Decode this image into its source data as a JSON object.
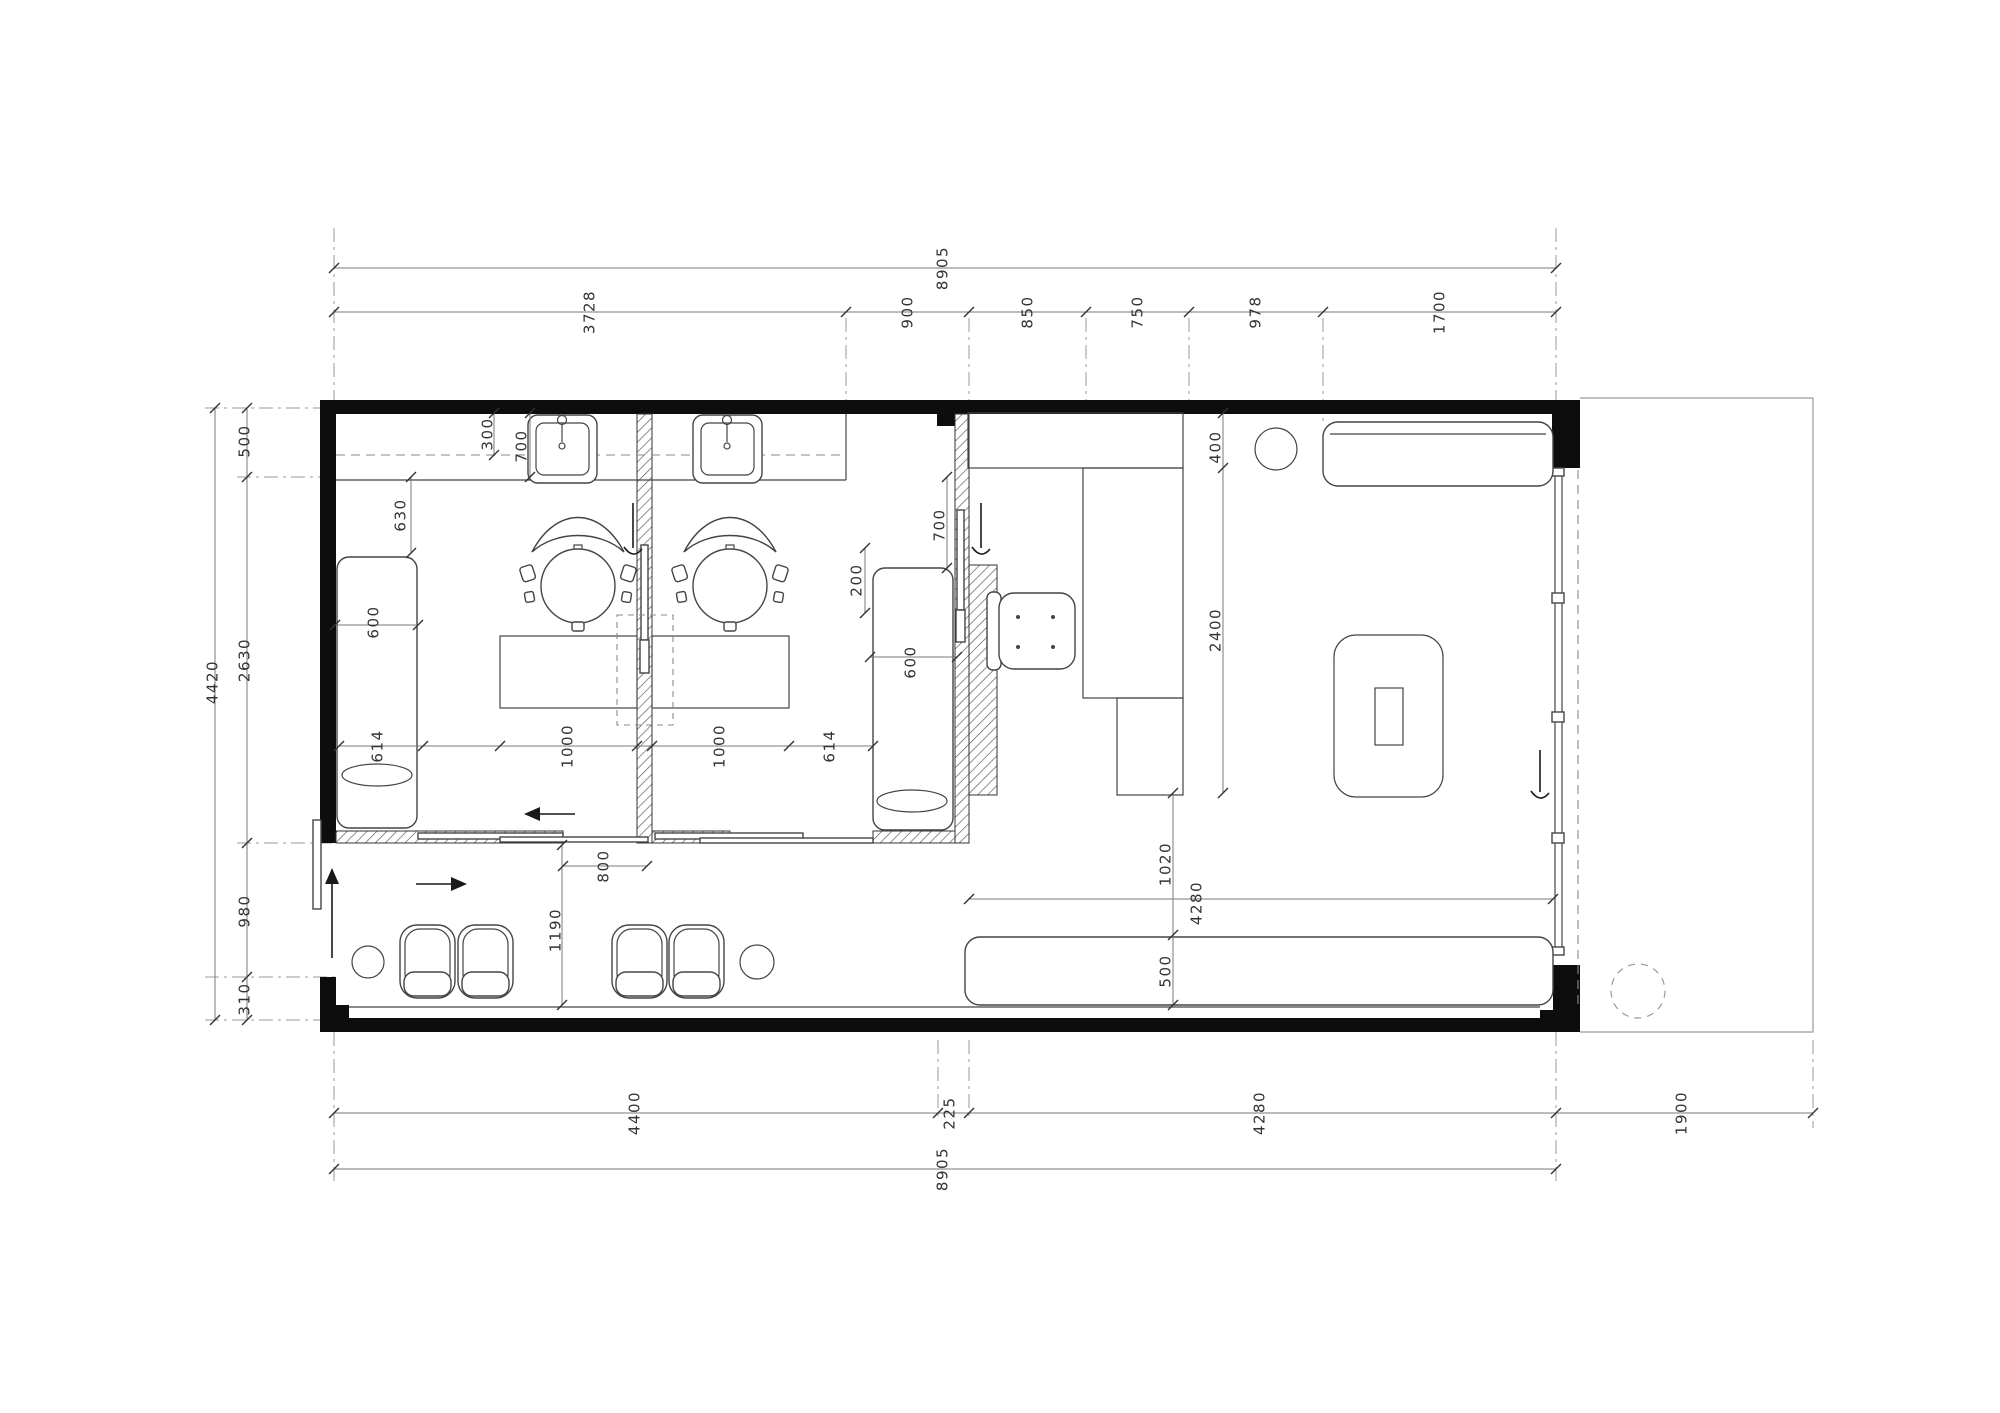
{
  "drawing": {
    "kind": "architectural floor plan",
    "colors": {
      "wall": "#0d0d0d",
      "line": "#444444",
      "dim": "#787878",
      "text": "#333333",
      "hatch": "#555555"
    }
  },
  "dimensions": [
    {
      "text": "8905",
      "x": 943,
      "y": 268
    },
    {
      "text": "3728",
      "x": 590,
      "y": 312
    },
    {
      "text": "900",
      "x": 908,
      "y": 312
    },
    {
      "text": "850",
      "x": 1028,
      "y": 312
    },
    {
      "text": "750",
      "x": 1138,
      "y": 312
    },
    {
      "text": "978",
      "x": 1256,
      "y": 312
    },
    {
      "text": "1700",
      "x": 1440,
      "y": 312
    },
    {
      "text": "4420",
      "x": 213,
      "y": 682
    },
    {
      "text": "500",
      "x": 245,
      "y": 441
    },
    {
      "text": "2630",
      "x": 245,
      "y": 660
    },
    {
      "text": "980",
      "x": 245,
      "y": 911
    },
    {
      "text": "310",
      "x": 245,
      "y": 999
    },
    {
      "text": "300",
      "x": 488,
      "y": 434
    },
    {
      "text": "630",
      "x": 401,
      "y": 515
    },
    {
      "text": "700",
      "x": 522,
      "y": 446
    },
    {
      "text": "600",
      "x": 374,
      "y": 622
    },
    {
      "text": "614",
      "x": 378,
      "y": 746
    },
    {
      "text": "1000",
      "x": 568,
      "y": 746
    },
    {
      "text": "800",
      "x": 604,
      "y": 866
    },
    {
      "text": "1190",
      "x": 556,
      "y": 930
    },
    {
      "text": "700",
      "x": 940,
      "y": 525
    },
    {
      "text": "200",
      "x": 857,
      "y": 580
    },
    {
      "text": "600",
      "x": 911,
      "y": 662
    },
    {
      "text": "1000",
      "x": 720,
      "y": 746
    },
    {
      "text": "614",
      "x": 830,
      "y": 746
    },
    {
      "text": "400",
      "x": 1216,
      "y": 447
    },
    {
      "text": "2400",
      "x": 1216,
      "y": 630
    },
    {
      "text": "1020",
      "x": 1166,
      "y": 864
    },
    {
      "text": "4280",
      "x": 1197,
      "y": 903
    },
    {
      "text": "500",
      "x": 1166,
      "y": 971
    },
    {
      "text": "4400",
      "x": 635,
      "y": 1113
    },
    {
      "text": "225",
      "x": 950,
      "y": 1113
    },
    {
      "text": "4280",
      "x": 1260,
      "y": 1113
    },
    {
      "text": "1900",
      "x": 1682,
      "y": 1113
    },
    {
      "text": "8905",
      "x": 943,
      "y": 1169
    }
  ],
  "ticks": {
    "horizontal": [
      {
        "y": 268,
        "xs": [
          334,
          1556
        ]
      },
      {
        "y": 312,
        "xs": [
          334,
          846,
          969,
          1086,
          1189,
          1323,
          1556
        ]
      },
      {
        "y": 746,
        "xs": [
          339,
          423,
          500,
          637,
          652,
          789,
          873
        ]
      },
      {
        "y": 625,
        "xs": [
          335,
          418
        ]
      },
      {
        "y": 657,
        "xs": [
          870,
          957
        ]
      },
      {
        "y": 866,
        "xs": [
          563,
          647
        ]
      },
      {
        "y": 899,
        "xs": [
          969,
          1553
        ]
      },
      {
        "y": 1113,
        "xs": [
          334,
          938,
          969,
          1556,
          1813
        ]
      },
      {
        "y": 1169,
        "xs": [
          334,
          1556
        ]
      }
    ],
    "vertical": [
      {
        "x": 215,
        "ys": [
          408,
          1020
        ]
      },
      {
        "x": 247,
        "ys": [
          408,
          477,
          843,
          977,
          1020
        ]
      },
      {
        "x": 494,
        "ys": [
          413,
          455
        ]
      },
      {
        "x": 411,
        "ys": [
          477,
          553
        ]
      },
      {
        "x": 530,
        "ys": [
          413,
          477
        ]
      },
      {
        "x": 947,
        "ys": [
          477,
          568
        ]
      },
      {
        "x": 865,
        "ys": [
          548,
          613
        ]
      },
      {
        "x": 562,
        "ys": [
          845,
          1005
        ]
      },
      {
        "x": 1223,
        "ys": [
          413,
          468,
          793
        ]
      },
      {
        "x": 1173,
        "ys": [
          793,
          935,
          1005
        ]
      }
    ]
  }
}
